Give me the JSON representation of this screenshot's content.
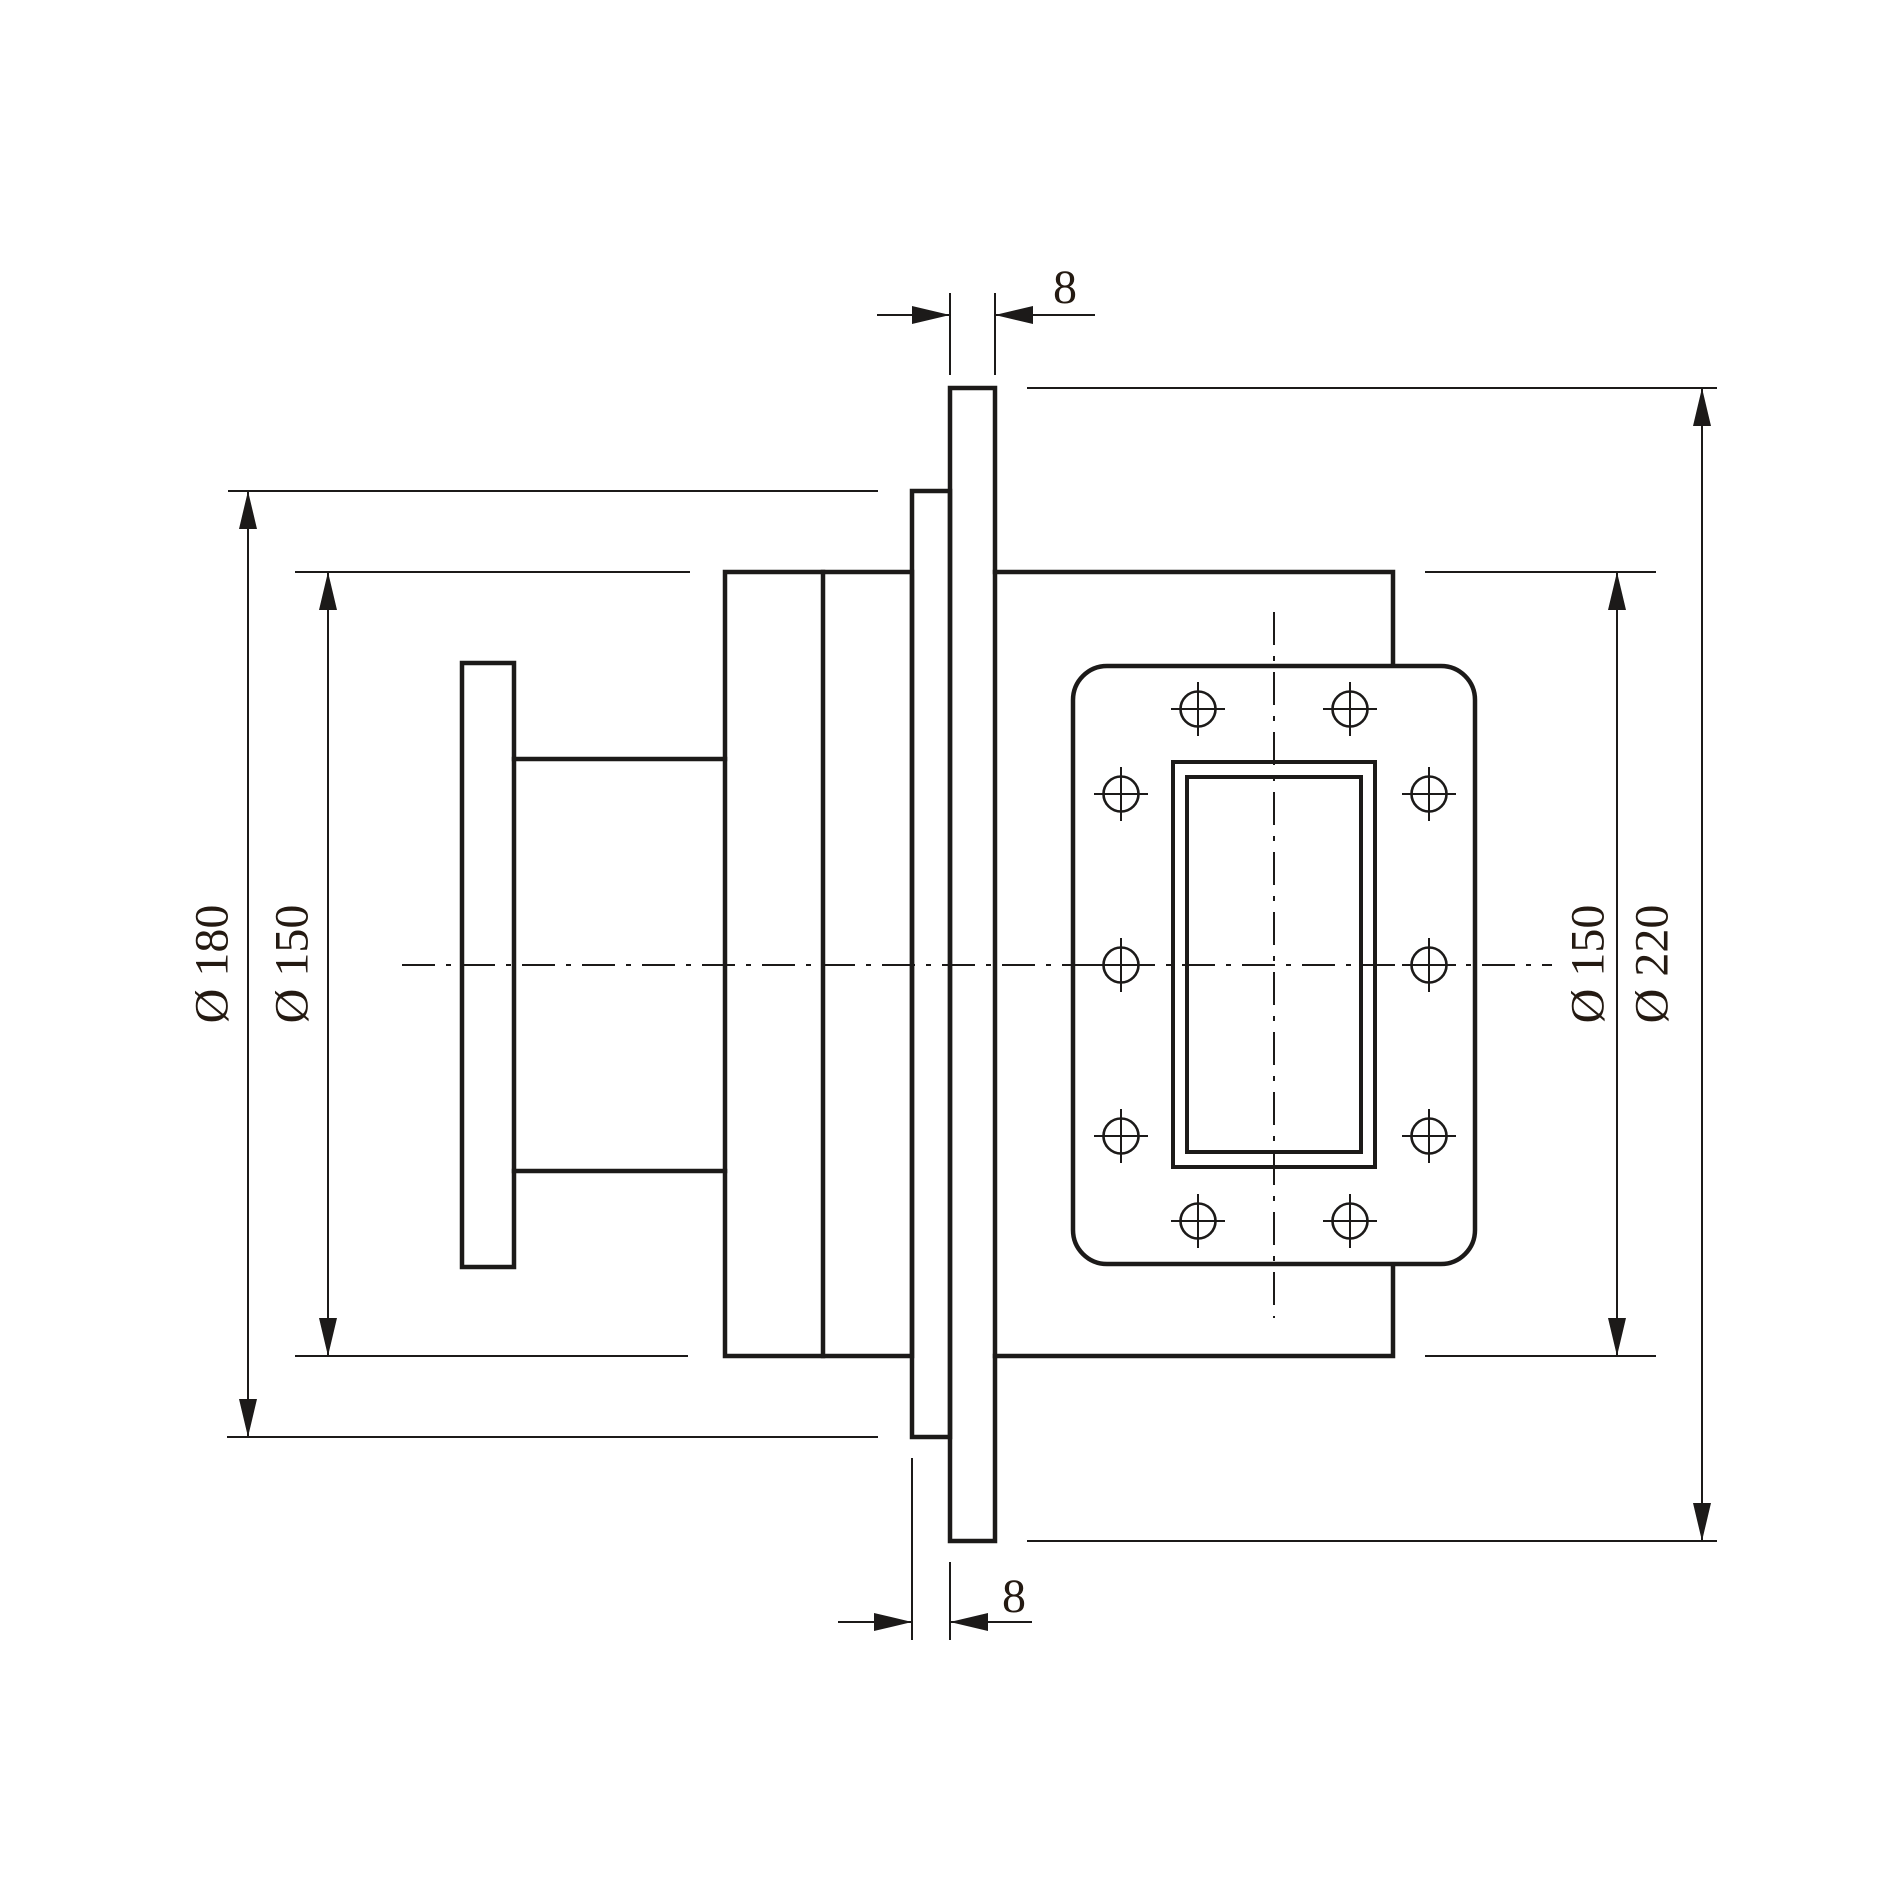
{
  "dimension_labels": {
    "gasket_plate_thickness_top": "8",
    "left_flange_outer_diameter": "Ø 180",
    "left_body_diameter": "Ø 150",
    "right_body_diameter": "Ø 150",
    "gasket_plate_diameter": "Ø 220",
    "rear_flange_thickness_bottom": "8"
  },
  "colors": {
    "line": "#1c1a19",
    "text": "#241a12",
    "background": "#ffffff"
  }
}
